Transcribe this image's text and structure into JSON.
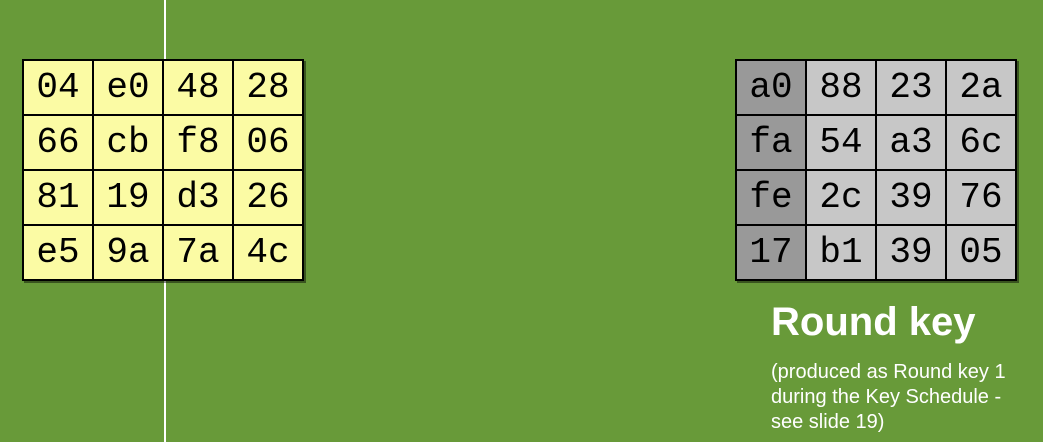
{
  "background_color": "#689A39",
  "divider_line_color": "#FFFFFF",
  "state_matrix": {
    "cell_color": "#FBFBA4",
    "border_color": "#000000",
    "text_color": "#000000",
    "rows": [
      [
        "04",
        "e0",
        "48",
        "28"
      ],
      [
        "66",
        "cb",
        "f8",
        "06"
      ],
      [
        "81",
        "19",
        "d3",
        "26"
      ],
      [
        "e5",
        "9a",
        "7a",
        "4c"
      ]
    ]
  },
  "round_key_matrix": {
    "first_column_color": "#999999",
    "cell_color": "#C7C7C7",
    "border_color": "#000000",
    "text_color": "#000000",
    "rows": [
      [
        "a0",
        "88",
        "23",
        "2a"
      ],
      [
        "fa",
        "54",
        "a3",
        "6c"
      ],
      [
        "fe",
        "2c",
        "39",
        "76"
      ],
      [
        "17",
        "b1",
        "39",
        "05"
      ]
    ]
  },
  "labels": {
    "title": "Round key",
    "caption": "(produced as Round key 1\nduring the Key Schedule -\nsee slide 19)",
    "text_color": "#FFFFFF"
  }
}
